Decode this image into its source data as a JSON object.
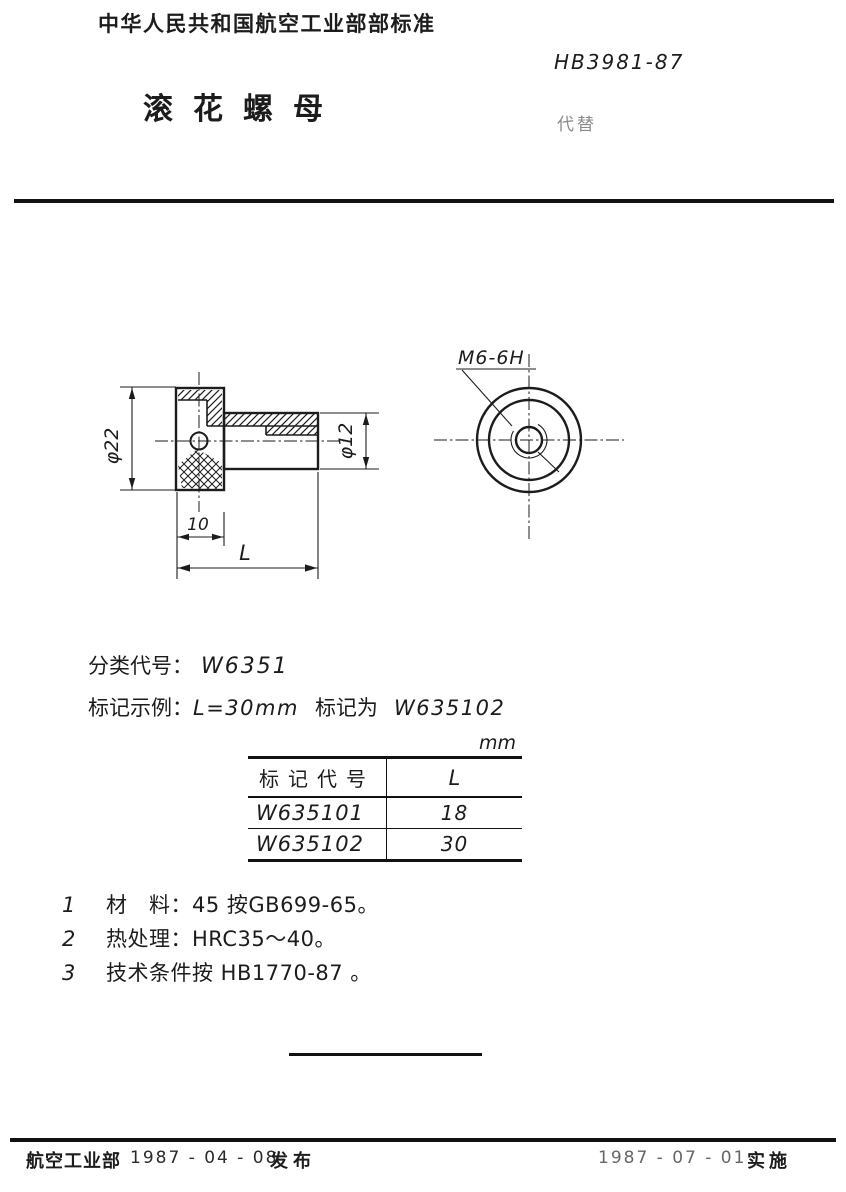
{
  "colors": {
    "ink": "#1c1c1c",
    "paper": "#ffffff",
    "faint_text": "#8a8a8a",
    "rule_line": "#111111"
  },
  "header": {
    "standard_body": "中华人民共和国航空工业部部标准",
    "standard_number": "HB3981-87",
    "replaces_label": "代替",
    "title": "滚花螺母"
  },
  "drawing": {
    "left_view": {
      "dim_head_diameter": "φ22",
      "dim_body_diameter": "φ12",
      "dim_head_length": "10",
      "dim_total_length": "L"
    },
    "right_view": {
      "thread_spec": "M6-6H"
    }
  },
  "classification": {
    "label": "分类代号：",
    "code": "W6351"
  },
  "marking_example": {
    "label": "标记示例：",
    "condition": "L=30mm",
    "designation_label": "标记为",
    "code": "W635102"
  },
  "table": {
    "unit_label": "mm",
    "columns": [
      "标记代号",
      "L"
    ],
    "rows": [
      [
        "W635101",
        "18"
      ],
      [
        "W635102",
        "30"
      ]
    ]
  },
  "notes": [
    {
      "num": "1",
      "text": "材　料：45 按GB699-65。"
    },
    {
      "num": "2",
      "text": "热处理：HRC35～40。"
    },
    {
      "num": "3",
      "text": "技术条件按 HB1770-87 。"
    }
  ],
  "footer": {
    "issuer": "航空工业部",
    "issue_date": "1987 - 04 - 08",
    "issue_action": "发布",
    "implement_date": "1987 - 07 - 01",
    "implement_action": "实施"
  }
}
